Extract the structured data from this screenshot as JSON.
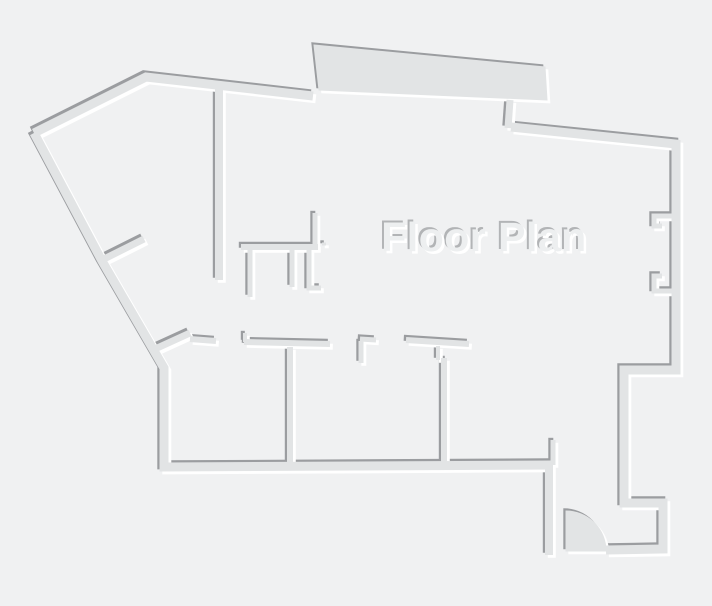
{
  "title": "Floor Plan",
  "canvas": {
    "width": 712,
    "height": 606
  },
  "colors": {
    "background": "#f0f1f2",
    "wall_fill": "#e2e4e5",
    "shadow_edge": "#9b9da0",
    "highlight_edge": "#ffffff",
    "label_fill": "#edeff0",
    "label_shadow": "#b2b4b6",
    "label_highlight": "#ffffff"
  },
  "label": {
    "text": "Floor Plan",
    "x": 484,
    "y": 251
  },
  "plan": {
    "emboss": {
      "shadow_dx": -2.2,
      "shadow_dy": -2.2,
      "highlight_dx": 2.8,
      "highlight_dy": 2.8
    },
    "strokes": [
      {
        "name": "top-left-outer-wall",
        "d": "M34,133 L146,77 L313,96",
        "w": 9
      },
      {
        "name": "left-and-bottom-outer-wall",
        "d": "M34,133 L102,261 L164,368 L164,467 L552,465",
        "w": 9
      },
      {
        "name": "right-outer-wall",
        "d": "M511,127 L676,144 L676,370 L624,370 L624,503 L663,503 L663,549 L606,550",
        "w": 9
      },
      {
        "name": "entrance-left-wall",
        "d": "M549,464 L549,555",
        "w": 8
      },
      {
        "name": "main-vertical-wall",
        "d": "M219,82 L219,280",
        "w": 8
      },
      {
        "name": "top-band-connector",
        "d": "M510,100 L508,128",
        "w": 7
      },
      {
        "name": "mid-horizontal-wall",
        "d": "M241,247 L318,247",
        "w": 6
      },
      {
        "name": "mid-row-wall-left",
        "d": "M190,339 L216,341",
        "w": 6
      },
      {
        "name": "mid-row-wall-center",
        "d": "M244,342 L330,344",
        "w": 6
      },
      {
        "name": "mid-row-wall-right",
        "d": "M406,340 L469,344",
        "w": 6
      },
      {
        "name": "room-divider-left",
        "d": "M290,347 L290,463",
        "w": 6
      },
      {
        "name": "room-divider-right",
        "d": "M444,358 L444,463",
        "w": 6
      },
      {
        "name": "diag-stub-upper",
        "d": "M104,259 L144,239",
        "w": 7
      },
      {
        "name": "diag-stub-lower",
        "d": "M155,349 L190,333",
        "w": 7
      },
      {
        "name": "stub-up",
        "d": "M315,213 L315,247",
        "w": 5
      },
      {
        "name": "stub-down-1",
        "d": "M250,248 L250,297",
        "w": 5
      },
      {
        "name": "stub-down-2",
        "d": "M292,248 L292,287",
        "w": 5
      },
      {
        "name": "l-wall",
        "d": "M309,248 L309,288 L321,288",
        "w": 5
      },
      {
        "name": "mid-row-l-bar",
        "d": "M360,339 L376,340",
        "w": 5
      },
      {
        "name": "mid-row-l-leg",
        "d": "M361,341 L361,363",
        "w": 5
      },
      {
        "name": "entrance-jamb-stub",
        "d": "M553,440 L553,465",
        "w": 5
      },
      {
        "name": "window-notch-upper",
        "d": "M673,216 L654,216 L654,226 L662,226",
        "w": 5
      },
      {
        "name": "window-notch-lower",
        "d": "M662,276 L654,276 L654,291 L673,291",
        "w": 5
      },
      {
        "name": "door-tab",
        "d": "M245,333 L245,342",
        "w": 4
      },
      {
        "name": "divider-jog",
        "d": "M438,346 L438,360",
        "w": 4
      },
      {
        "name": "wall-dot",
        "d": "M322,244 L326,244",
        "w": 3
      }
    ],
    "fills": [
      {
        "name": "top-band",
        "d": "M314,45 L545,67 L547,100 L319,90 Z"
      },
      {
        "name": "door-swing",
        "d": "M566,551 L566,511 A40 40 0 0 1 606,551 Z"
      }
    ]
  }
}
